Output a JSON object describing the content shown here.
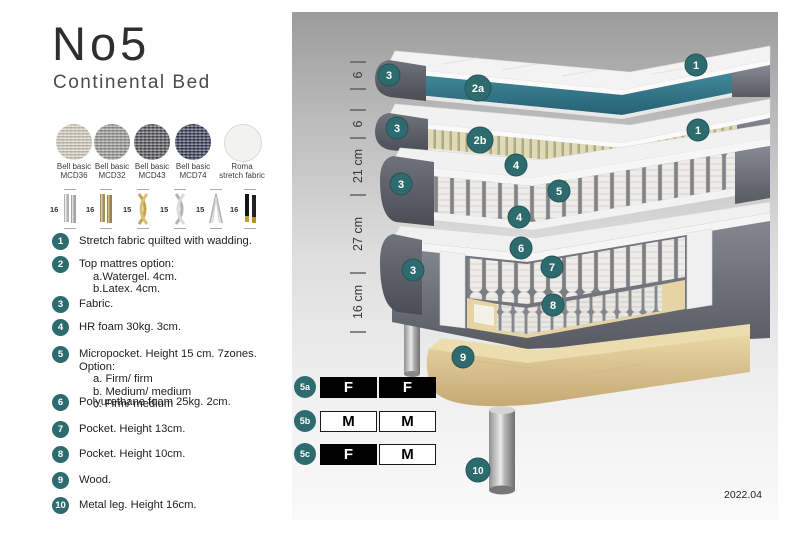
{
  "title": "No5",
  "subtitle": "Continental Bed",
  "fabrics": [
    {
      "line1": "Bell basic",
      "line2": "MCD36"
    },
    {
      "line1": "Bell basic",
      "line2": "MCD32"
    },
    {
      "line1": "Bell basic",
      "line2": "MCD43"
    },
    {
      "line1": "Bell basic",
      "line2": "MCD74"
    },
    {
      "line1": "Roma",
      "line2": "stretch fabric"
    }
  ],
  "leg_options": [
    {
      "size": "16",
      "style": "chrome-cylinder"
    },
    {
      "size": "16",
      "style": "brass-cylinder"
    },
    {
      "size": "15",
      "style": "gold-twisted"
    },
    {
      "size": "15",
      "style": "chrome-twisted"
    },
    {
      "size": "15",
      "style": "hairpin"
    },
    {
      "size": "16",
      "style": "black-gold-tip"
    }
  ],
  "features": [
    {
      "num": "1",
      "text": "Stretch fabric quilted with wadding.",
      "subs": []
    },
    {
      "num": "2",
      "text": "Top mattres option:",
      "subs": [
        "a.Watergel. 4cm.",
        "b.Latex. 4cm."
      ]
    },
    {
      "num": "3",
      "text": "Fabric.",
      "subs": []
    },
    {
      "num": "4",
      "text": "HR foam 30kg. 3cm.",
      "subs": []
    },
    {
      "num": "5",
      "text": "Micropocket. Height 15 cm. 7zones. Option:",
      "subs": [
        "a. Firm/ firm",
        "b. Medium/ medium",
        "c. Firm/ medium"
      ]
    },
    {
      "num": "6",
      "text": "Polyurethane foam 25kg. 2cm.",
      "subs": []
    },
    {
      "num": "7",
      "text": "Pocket. Height 13cm.",
      "subs": []
    },
    {
      "num": "8",
      "text": "Pocket. Height 10cm.",
      "subs": []
    },
    {
      "num": "9",
      "text": "Wood.",
      "subs": []
    },
    {
      "num": "10",
      "text": "Metal leg. Height 16cm.",
      "subs": []
    }
  ],
  "diagram": {
    "measurements": [
      "6",
      "6",
      "21 cm",
      "27 cm",
      "16 cm"
    ],
    "badges": [
      {
        "label": "1"
      },
      {
        "label": "2a"
      },
      {
        "label": "3"
      },
      {
        "label": "1"
      },
      {
        "label": "2b"
      },
      {
        "label": "3"
      },
      {
        "label": "4"
      },
      {
        "label": "5"
      },
      {
        "label": "4"
      },
      {
        "label": "3"
      },
      {
        "label": "6"
      },
      {
        "label": "7"
      },
      {
        "label": "8"
      },
      {
        "label": "3"
      },
      {
        "label": "9"
      },
      {
        "label": "10"
      }
    ],
    "firmness_table": [
      {
        "id": "5a",
        "cells": [
          {
            "label": "F",
            "variant": "dark"
          },
          {
            "label": "F",
            "variant": "dark"
          }
        ]
      },
      {
        "id": "5b",
        "cells": [
          {
            "label": "M",
            "variant": "light"
          },
          {
            "label": "M",
            "variant": "light"
          }
        ]
      },
      {
        "id": "5c",
        "cells": [
          {
            "label": "F",
            "variant": "dark"
          },
          {
            "label": "M",
            "variant": "light"
          }
        ]
      }
    ],
    "version": "2022.04",
    "colors": {
      "badge": "#2e6b6e",
      "watergel": "#35798a",
      "latex": "#ddd8b2",
      "fabric_gray": "#6e717b",
      "wood": "#e2cf9f"
    }
  }
}
